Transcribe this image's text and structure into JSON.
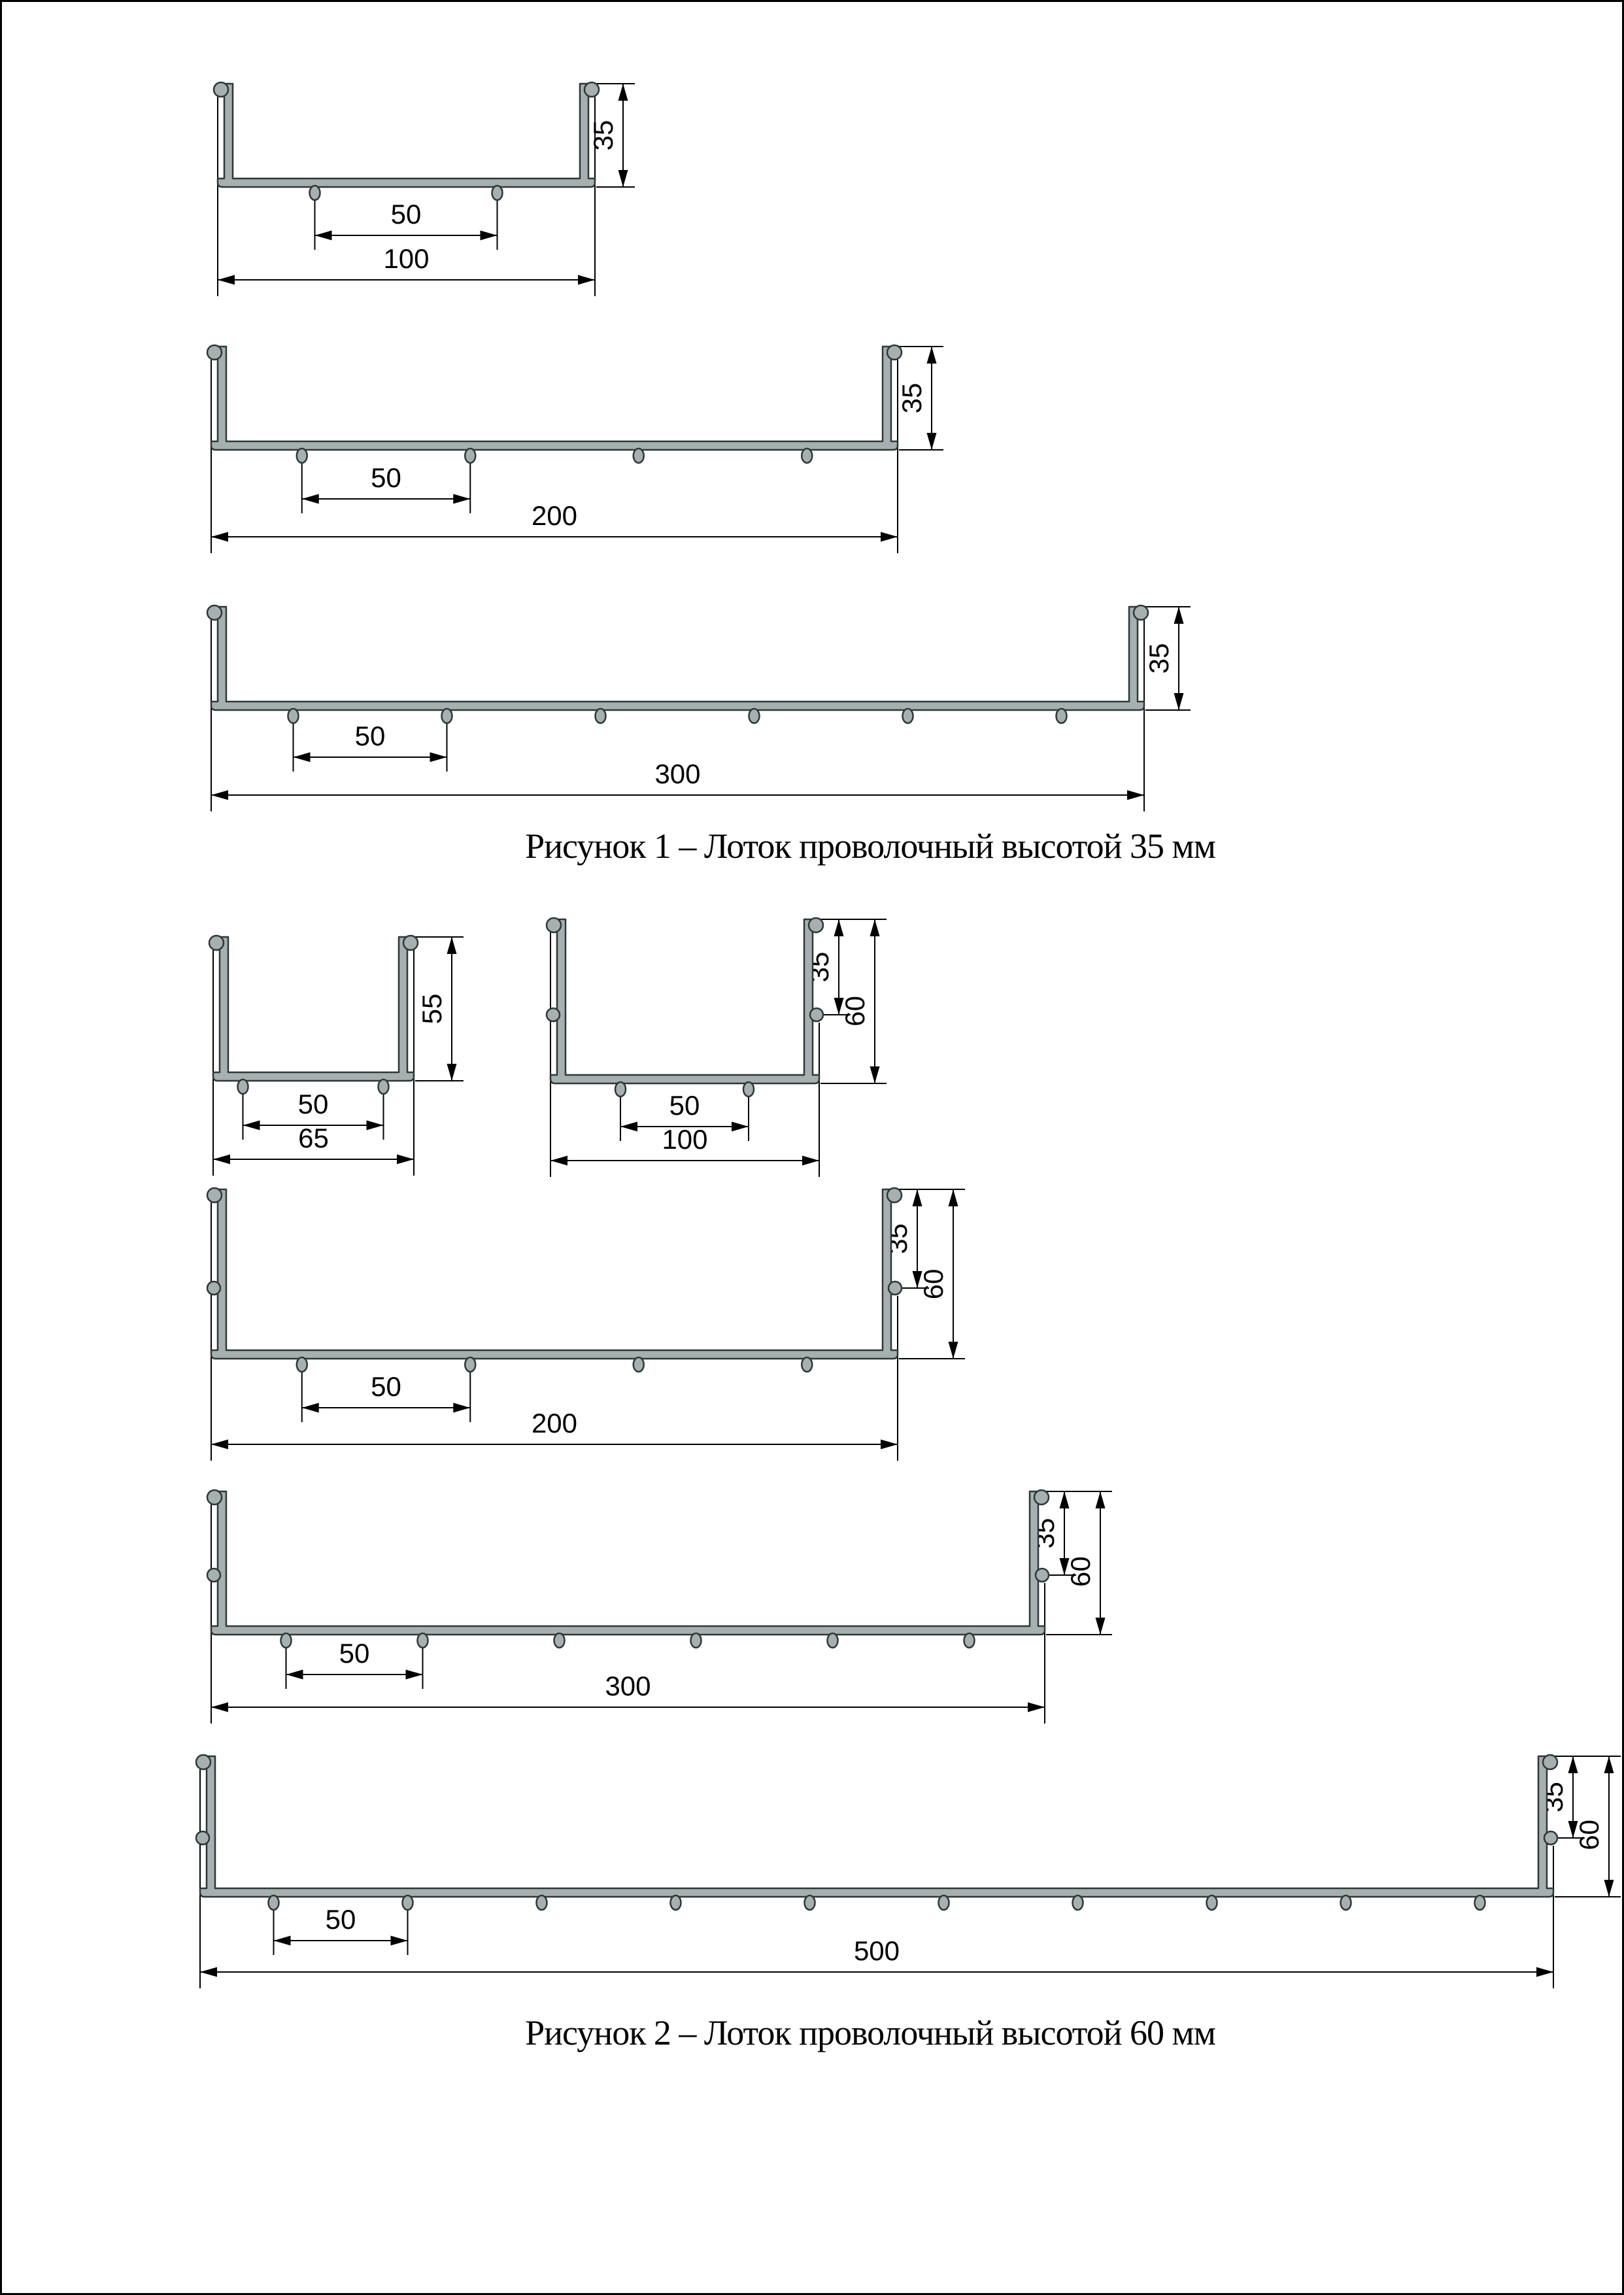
{
  "document": {
    "figures": [
      {
        "caption": "Рисунок 1 – Лоток проволочный высотой 35 мм",
        "profiles": [
          {
            "width_label": "100",
            "height_label": "35",
            "wire_pitch_label": "50",
            "bottom_wire_count": 2,
            "has_mid_wire": false
          },
          {
            "width_label": "200",
            "height_label": "35",
            "wire_pitch_label": "50",
            "bottom_wire_count": 4,
            "has_mid_wire": false
          },
          {
            "width_label": "300",
            "height_label": "35",
            "wire_pitch_label": "50",
            "bottom_wire_count": 6,
            "has_mid_wire": false
          }
        ]
      },
      {
        "caption": "Рисунок 2 – Лоток проволочный высотой 60 мм",
        "profiles": [
          {
            "width_label": "65",
            "height_label": "55",
            "wire_pitch_label": "50",
            "bottom_wire_count": 2,
            "has_mid_wire": false
          },
          {
            "width_label": "100",
            "height_label": "60",
            "upper_height_label": "35",
            "wire_pitch_label": "50",
            "bottom_wire_count": 2,
            "has_mid_wire": true
          },
          {
            "width_label": "200",
            "height_label": "60",
            "upper_height_label": "35",
            "wire_pitch_label": "50",
            "bottom_wire_count": 4,
            "has_mid_wire": true
          },
          {
            "width_label": "300",
            "height_label": "60",
            "upper_height_label": "35",
            "wire_pitch_label": "50",
            "bottom_wire_count": 6,
            "has_mid_wire": true
          },
          {
            "width_label": "500",
            "height_label": "60",
            "upper_height_label": "35",
            "wire_pitch_label": "50",
            "bottom_wire_count": 10,
            "has_mid_wire": true
          }
        ]
      }
    ],
    "colors": {
      "background": "#ffffff",
      "page_border": "#000000",
      "profile_fill": "#a6b0b0",
      "profile_stroke": "#2f3737",
      "dimension_color": "#000000"
    }
  }
}
